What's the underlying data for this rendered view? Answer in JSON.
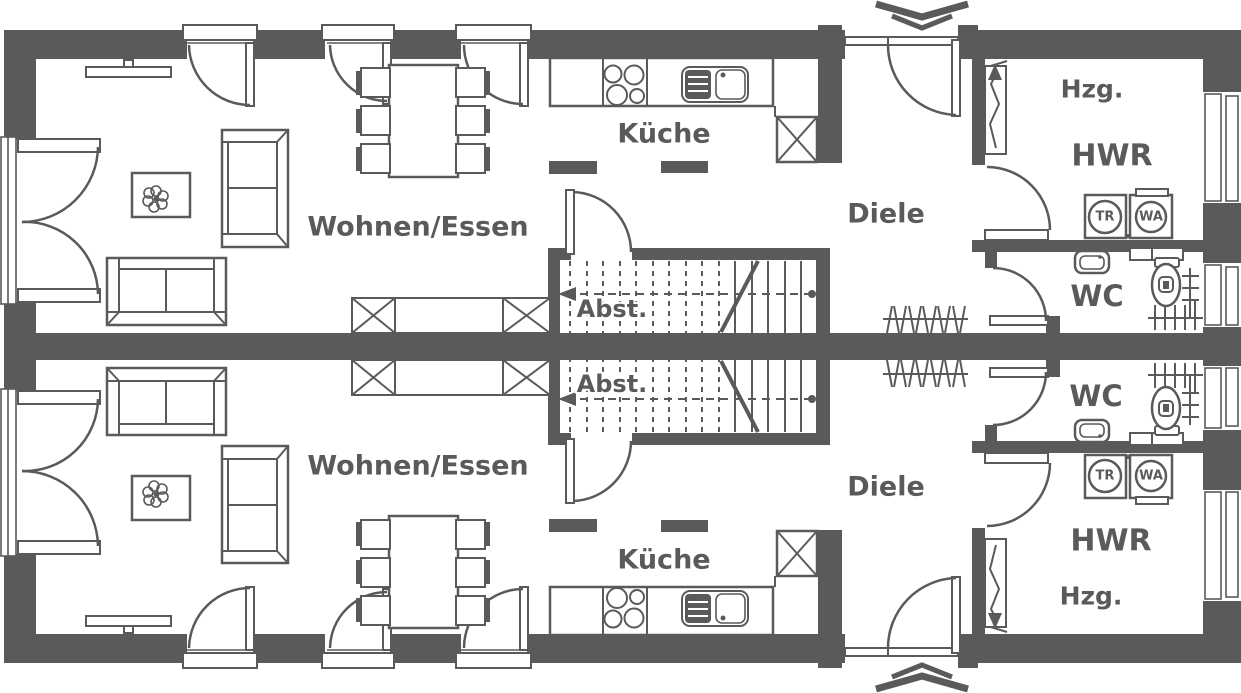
{
  "palette": {
    "ink": "#5a5a5a",
    "paper": "#ffffff"
  },
  "plan": {
    "type": "residential-floor-plan",
    "units_count": 2,
    "rooms": {
      "living_dining": "Wohnen/Essen",
      "kitchen": "Küche",
      "hall": "Diele",
      "storage": "Abst.",
      "utility_room": "HWR",
      "wc": "WC",
      "heating": "Hzg."
    },
    "appliances": {
      "dryer": "TR",
      "washing_machine": "WA"
    },
    "icons": {
      "entrance_marker": "double-chevron",
      "electric_riser": "zigzag-arrow",
      "shaft": "crossed-box",
      "stair_direction": "dashed-arrow-line",
      "radiator": "hatched-line",
      "plant": "flower"
    }
  }
}
